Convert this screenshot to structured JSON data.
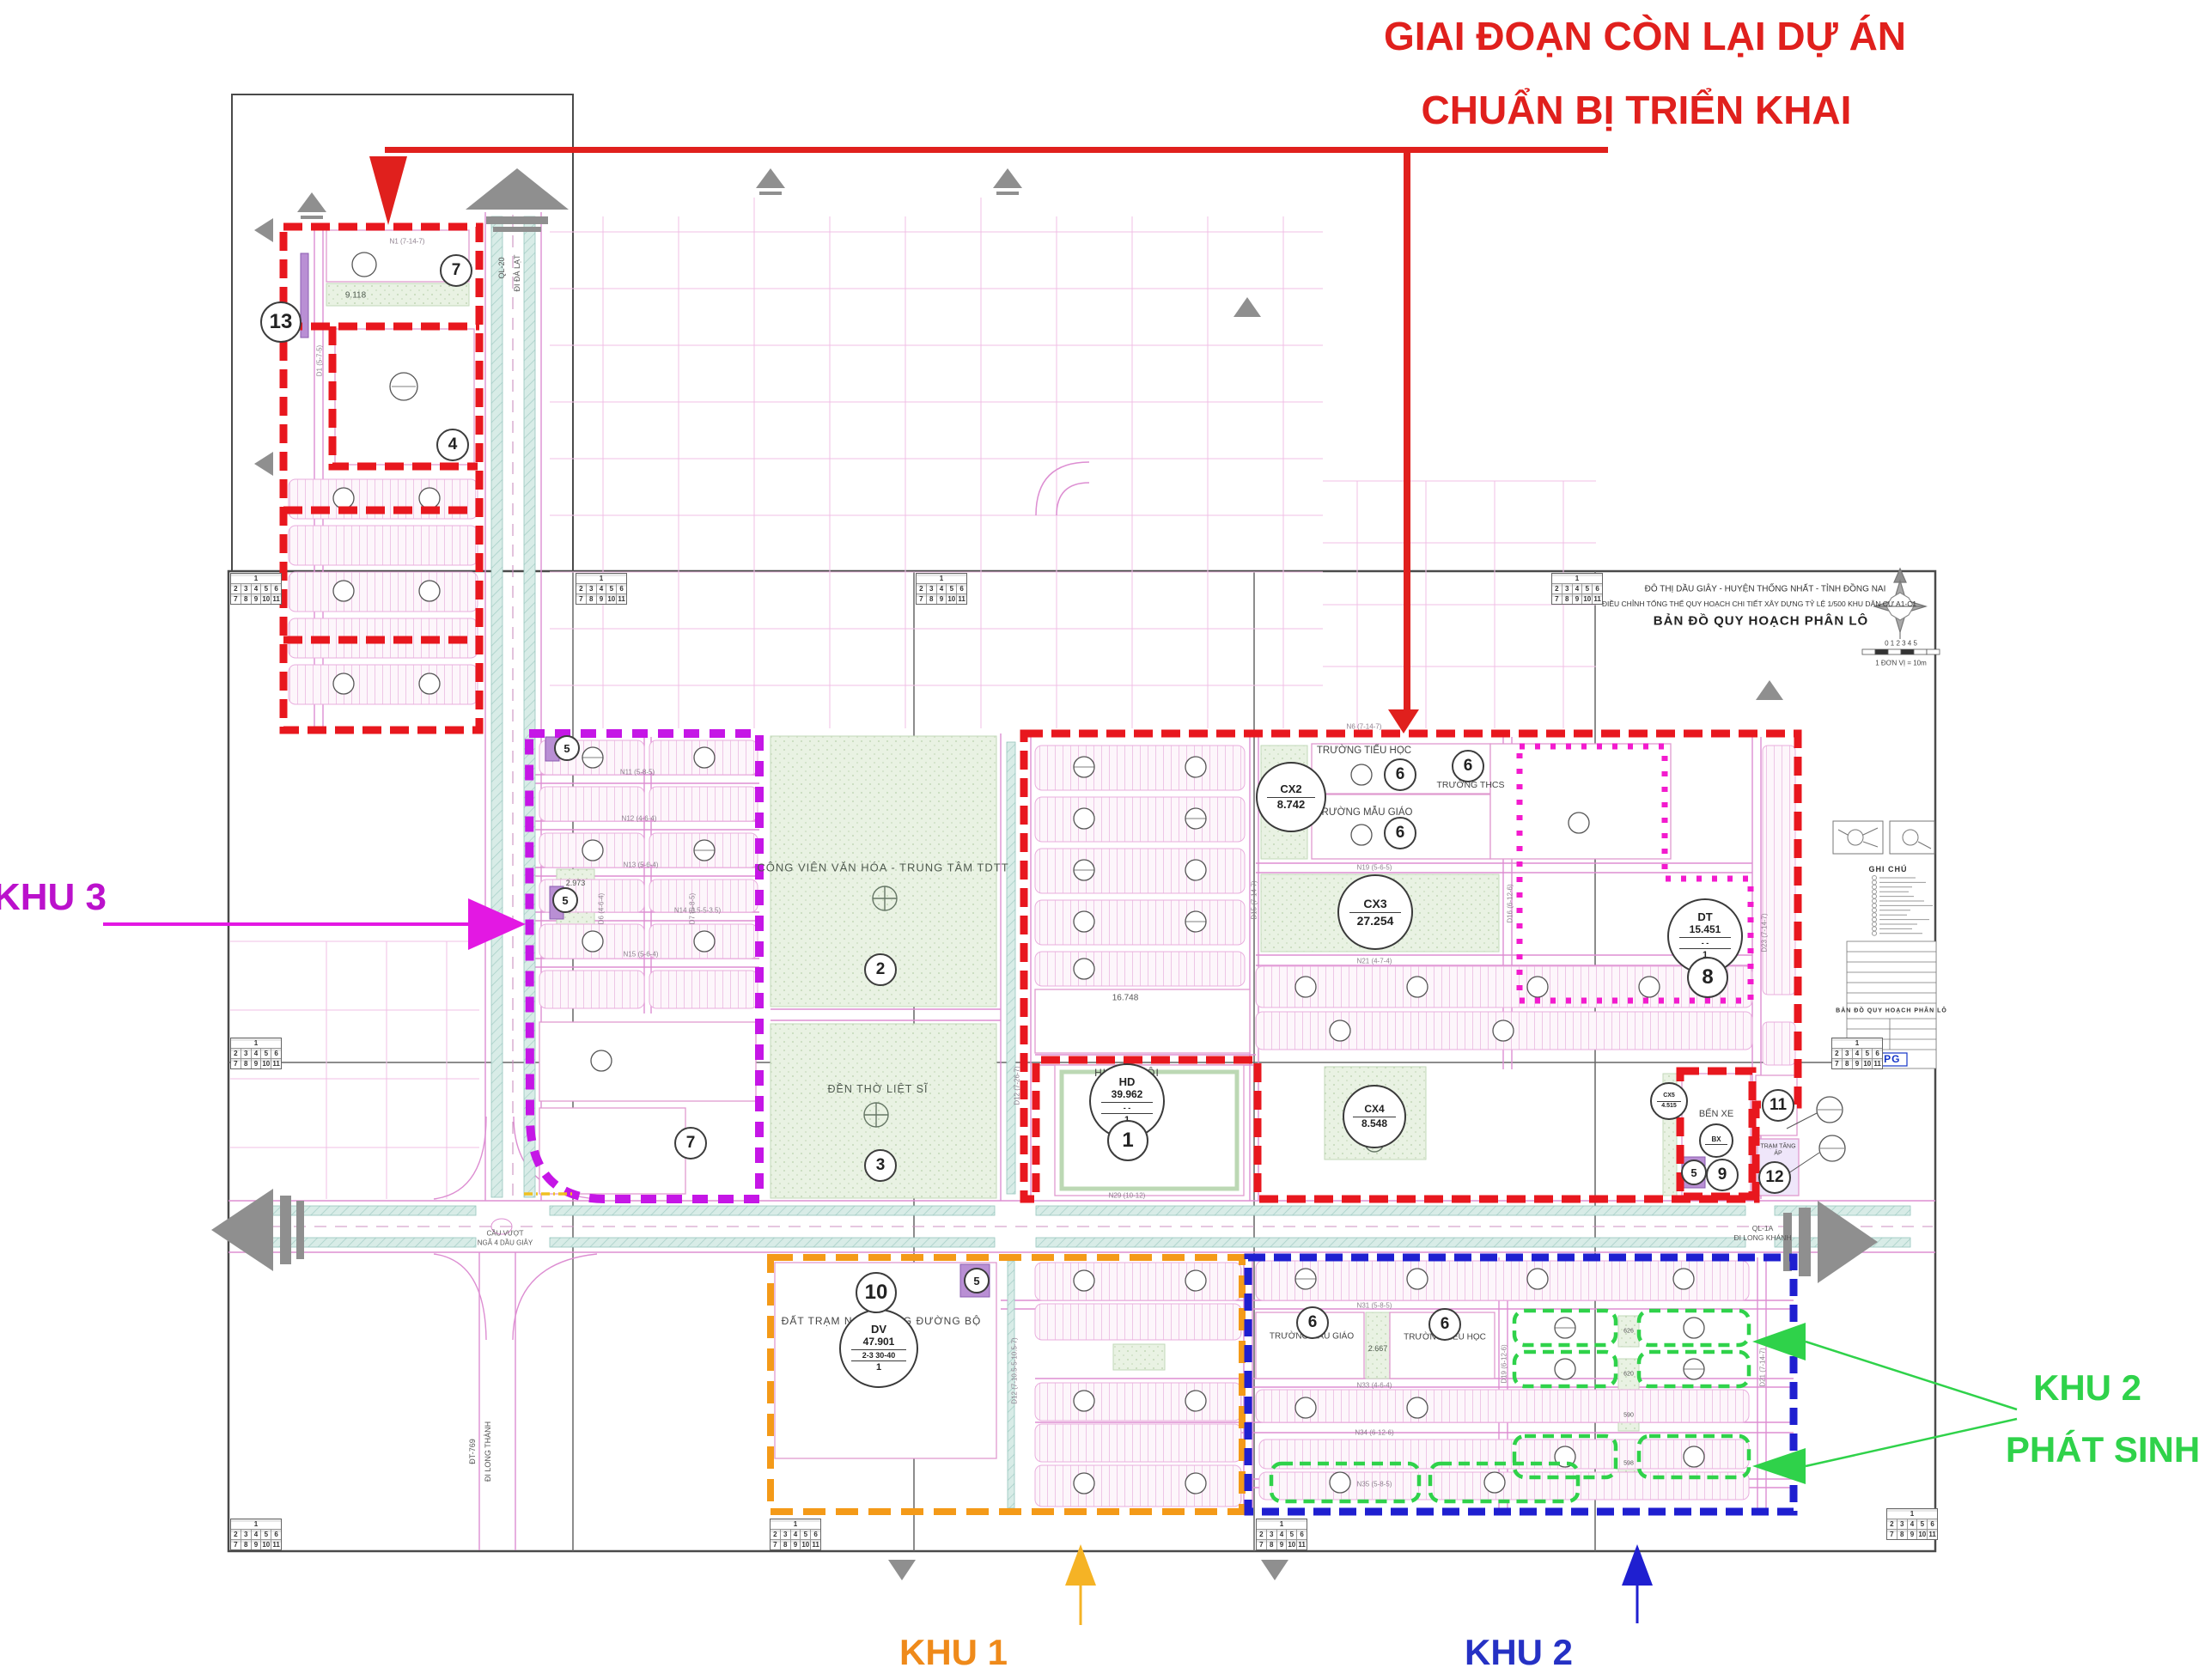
{
  "annotations": {
    "remaining": {
      "line1": "GIAI ĐOẠN CÒN LẠI DỰ ÁN",
      "line2": "CHUẨN BỊ TRIỂN KHAI"
    },
    "khu3": "KHU 3",
    "khu1": "KHU 1",
    "khu2": "KHU 2",
    "khu2ps": {
      "line1": "KHU 2",
      "line2": "PHÁT SINH"
    }
  },
  "title_block": {
    "line1": "ĐÔ THỊ DẦU GIÂY - HUYỆN THỐNG NHẤT - TỈNH ĐỒNG NAI",
    "line2": "ĐIỀU CHỈNH TỔNG THỂ QUY HOẠCH CHI TIẾT XÂY DỰNG TỶ LỆ 1/500 KHU DÂN CƯ A1-C1",
    "line3": "BẢN ĐỒ QUY HOẠCH PHÂN LÔ",
    "scale_ticks": "0    1    2    3    4    5",
    "scale_note": "1 ĐƠN VỊ = 10m"
  },
  "legend": {
    "title": "GHI CHÚ",
    "logo": "CPG",
    "table_title": "BẢN ĐỒ QUY HOẠCH PHÂN LÔ"
  },
  "sheet_index": {
    "r1": "1",
    "r2": [
      "2",
      "3",
      "4",
      "5",
      "6"
    ],
    "r3": [
      "7",
      "8",
      "9",
      "10",
      "11"
    ]
  },
  "places": {
    "park": "CÔNG VIÊN VĂN HÓA - TRUNG TÂM TDTT",
    "temple": "ĐỀN THỜ LIỆT SĨ",
    "huyen_doi": "HUYỆN ĐỘI",
    "ben_xe": "BẾN XE",
    "tram_tang_ap": "TRẠM TĂNG ÁP",
    "truong_tieu_hoc": "TRƯỜNG TIỂU HỌC",
    "truong_mau_giao": "TRƯỜNG MẪU GIÁO",
    "truong_thcs": "TRƯỜNG THCS",
    "dat_tram_nghi": "ĐẤT TRẠM NGHỈ DỪNG ĐƯỜNG BỘ",
    "cau_vuot_1": "CẦU VƯỢT",
    "cau_vuot_2": "NGÃ 4 DẦU GIÂY"
  },
  "roads": {
    "ql20": "QL-20",
    "di_da_lat": "ĐI ĐÀ LẠT",
    "ql1a_e1": "QL-1A",
    "ql1a_e2": "ĐI LONG KHÁNH",
    "dt769_1": "ĐT-769",
    "dt769_2": "ĐI LONG THÀNH",
    "n1": "N1 (7-14-7)",
    "n6": "N6 (7-14-7)",
    "n11": "N11 (5-8-5)",
    "n12": "N12 (4-6-4)",
    "n13": "N13 (5-6-4)",
    "n14": "N14 (3.5-5-3.5)",
    "n15": "N15 (5-6-4)",
    "n19": "N19 (5-6-5)",
    "n21": "N21 (4-7-4)",
    "n29": "N29 (10-12)",
    "n31": "N31 (5-8-5)",
    "n33": "N33 (4-6-4)",
    "n34": "N34 (6-12-6)",
    "n35": "N35 (5-8-5)",
    "d1": "D1 (5-7-5)",
    "d6": "D6 (4-6-4)",
    "d7": "D7 (5-8-5)",
    "d12": "D12 (7-26-7)",
    "d12b": "D12 (7-10.5-5-10.5-7)",
    "d15": "D15 (7-14-7)",
    "d16": "D16 (6-12-6)",
    "d19": "D19 (6-12-6)",
    "d21": "D21 (7-14-7)",
    "d23": "D23 (7-14-7)"
  },
  "blocks": {
    "cx2": {
      "code": "CX2",
      "area": "8.742"
    },
    "cx3": {
      "code": "CX3",
      "area": "27.254"
    },
    "cx4": {
      "code": "CX4",
      "area": "8.548"
    },
    "cx5": {
      "code": "CX5",
      "area": "4.515"
    },
    "hd": {
      "code": "HD",
      "area": "39.962",
      "mid": "-      -",
      "num": "1"
    },
    "dv": {
      "code": "DV",
      "area": "47.901",
      "mid": "2-3  30-40",
      "num": "1"
    },
    "dt": {
      "code": "DT",
      "area": "15.451",
      "mid": "-      -",
      "num": "1"
    },
    "bx": {
      "code": "BX"
    },
    "green_a": "9.118",
    "block_16748": "16.748",
    "strip_2667": "2.667",
    "strip_2973": "2.973",
    "tiles": [
      "626",
      "620",
      "590",
      "598"
    ]
  },
  "badges": {
    "v1": "1",
    "v2": "2",
    "v3": "3",
    "v4": "4",
    "v5": "5",
    "v6": "6",
    "v7": "7",
    "v8": "8",
    "v9": "9",
    "v10": "10",
    "v11": "11",
    "v12": "12",
    "v13": "13"
  },
  "colors": {
    "red": "#e8171e",
    "purple": "#c516e6",
    "pink_dotted": "#f31bce",
    "orange": "#f49a18",
    "blue": "#1f1fd0",
    "green": "#2fd24a",
    "teal": "#cfe9e3",
    "park": "#e9f2e3"
  }
}
